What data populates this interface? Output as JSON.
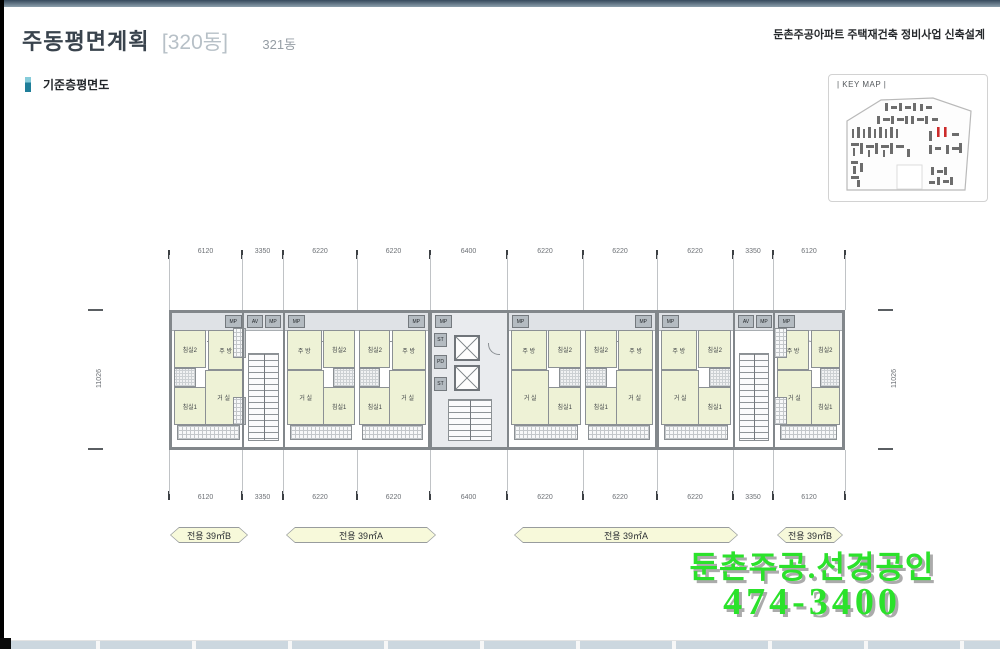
{
  "page": {
    "title": "주동평면계획",
    "block": "[320동]",
    "tab": "321동",
    "header_right": "둔촌주공아파트 주택재건축 정비사업 신축설계",
    "section": "기준층평면도",
    "keymap": "| KEY MAP |"
  },
  "plan": {
    "dims_top": [
      "6120",
      "3350",
      "6220",
      "6220",
      "6400",
      "6220",
      "6220",
      "6220",
      "3350",
      "6120"
    ],
    "dims_bottom": [
      "6120",
      "3350",
      "6220",
      "6220",
      "6400",
      "6220",
      "6220",
      "6220",
      "3350",
      "6120"
    ],
    "dim_left": "11026",
    "dim_right": "11026",
    "rooms": {
      "bed2": "침실2",
      "bed1": "침실1",
      "living": "거 실",
      "kitchen": "주 방"
    },
    "svc": {
      "mp": "MP",
      "av": "AV",
      "st": "ST",
      "pd": "PD"
    },
    "units": [
      {
        "type": "B",
        "mirror": true
      },
      {
        "type": "stair"
      },
      {
        "type": "A",
        "mirror": false
      },
      {
        "type": "A",
        "mirror": true
      },
      {
        "type": "core"
      },
      {
        "type": "A",
        "mirror": false
      },
      {
        "type": "A",
        "mirror": true
      },
      {
        "type": "A",
        "mirror": false
      },
      {
        "type": "stair"
      },
      {
        "type": "B",
        "mirror": false
      }
    ]
  },
  "banners": [
    {
      "label": "전용 39㎡B"
    },
    {
      "label": "전용 39㎡A"
    },
    {
      "label": "전용 39㎡A"
    },
    {
      "label": "전용 39㎡B"
    }
  ],
  "watermark": {
    "line1": "둔촌주공.선경공인",
    "line2": "474-3400"
  },
  "colors": {
    "accent_teal": "#1f7e99",
    "room_fill": "#eef2d6",
    "wall_gray": "#82878b",
    "watermark_green": "#2be22b",
    "keymap_highlight_red": "#cc2b2b"
  }
}
